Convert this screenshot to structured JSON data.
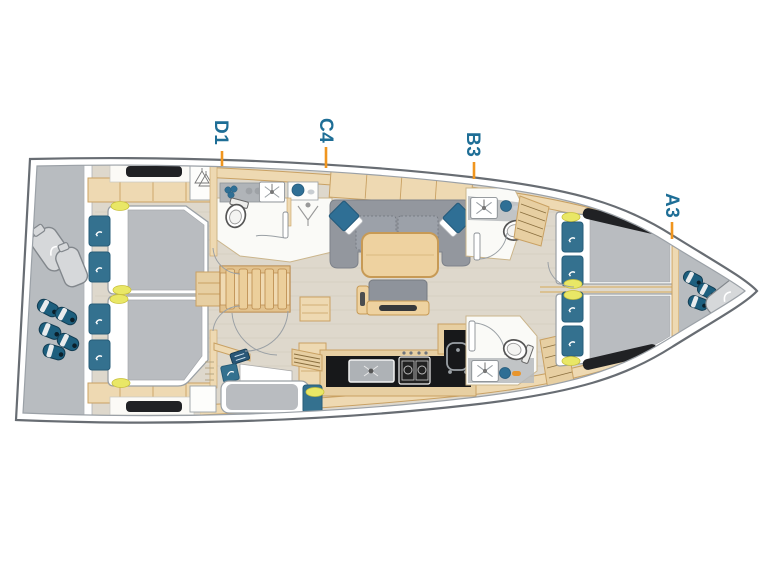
{
  "diagram": {
    "cabin_labels": [
      {
        "text": "D1"
      },
      {
        "text": "C4"
      },
      {
        "text": "B3"
      },
      {
        "text": "A3"
      }
    ],
    "colors": {
      "label_text": "#1e6e96",
      "leader_line": "#f0951e",
      "hull_outline": "#686d73",
      "inner_hull_line": "#9ba1a7",
      "deck_gray": "#b8bcc0",
      "floor": "#ded8cc",
      "wood": "#eed9b2",
      "wood_dark": "#c9a163",
      "stair_wood": "#e9cd9d",
      "upholstery_gray": "#93979e",
      "cushion_blue": "#2f6f95",
      "pillow_blue": "#34718f",
      "duvet_gray": "#b9bcc0",
      "window_dark": "#202124",
      "galley_black": "#17181a",
      "fender_blue": "#1d5f7e",
      "bag_gray": "#d6d8da",
      "light_yellow": "#e9e766",
      "fixture_white": "#fafaf7"
    }
  }
}
